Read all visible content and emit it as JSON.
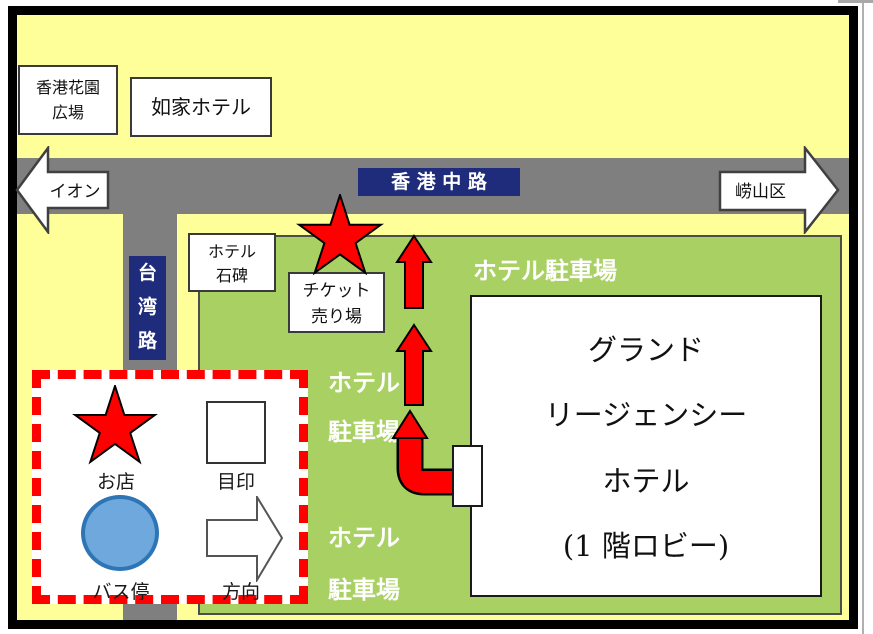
{
  "signs": {
    "hongkong_road": "香 港 中 路",
    "taiwan_road_chars": [
      "台",
      "湾",
      "路"
    ],
    "dir_left": "イオン",
    "dir_right": "崂山区"
  },
  "buildings": {
    "garden_plaza_line1": "香港花園",
    "garden_plaza_line2": "広場",
    "rujia_hotel": "如家ホテル",
    "stone_line1": "ホテル",
    "stone_line2": "石碑",
    "ticket_line1": "チケット",
    "ticket_line2": "売り場",
    "grand_line1": "グランド",
    "grand_line2": "リージェンシー",
    "grand_line3": "ホテル",
    "grand_line4": "(1 階ロビー)"
  },
  "parking": {
    "top": "ホテル駐車場",
    "mid_line1": "ホテル",
    "mid_line2": "駐車場",
    "bottom_line1": "ホテル",
    "bottom_line2": "駐車場"
  },
  "legend": {
    "items": [
      {
        "symbol": "star",
        "label": "お店"
      },
      {
        "symbol": "square",
        "label": "目印"
      },
      {
        "symbol": "circle",
        "label": "バス停"
      },
      {
        "symbol": "arrow",
        "label": "方向"
      }
    ]
  },
  "colors": {
    "background": "#FFFF99",
    "road": "#7F7F7F",
    "road_sign": "#1F2C7B",
    "hotel_grounds": "#A8D062",
    "route": "#FF0000",
    "bus_stop_fill": "#6FA8DC",
    "bus_stop_border": "#2E75B6"
  }
}
